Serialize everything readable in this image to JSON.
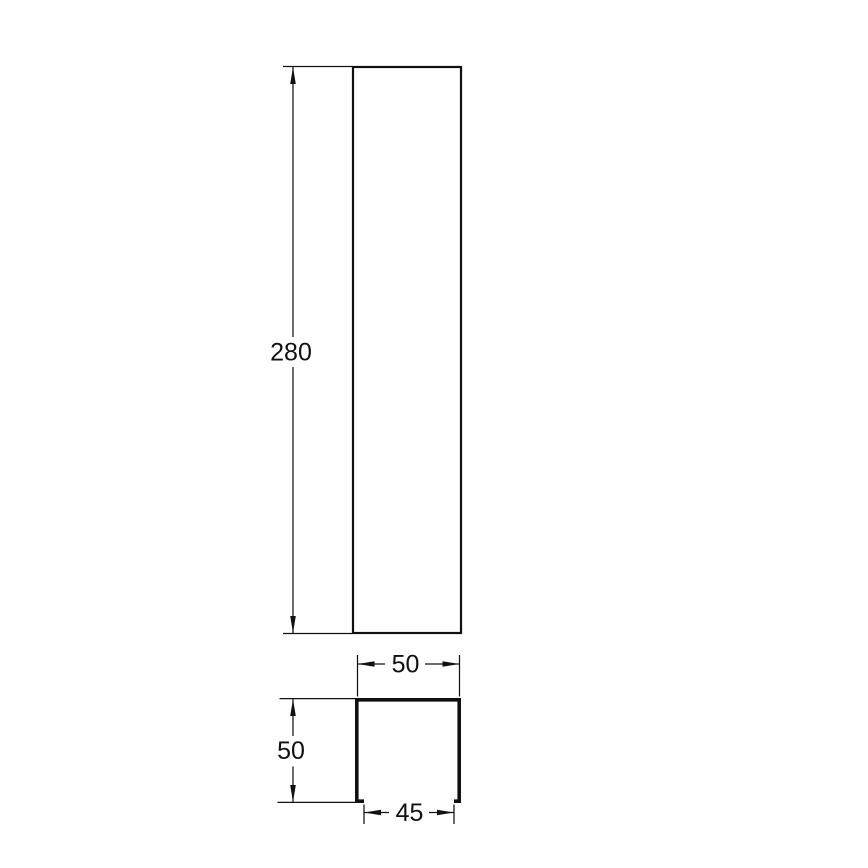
{
  "colors": {
    "line": "#111111",
    "text": "#111111",
    "background": "#ffffff"
  },
  "dimensions": {
    "front_height": {
      "label": "280"
    },
    "section_outer_width": {
      "label": "50"
    },
    "section_height": {
      "label": "50"
    },
    "section_inner_width": {
      "label": "45"
    }
  }
}
